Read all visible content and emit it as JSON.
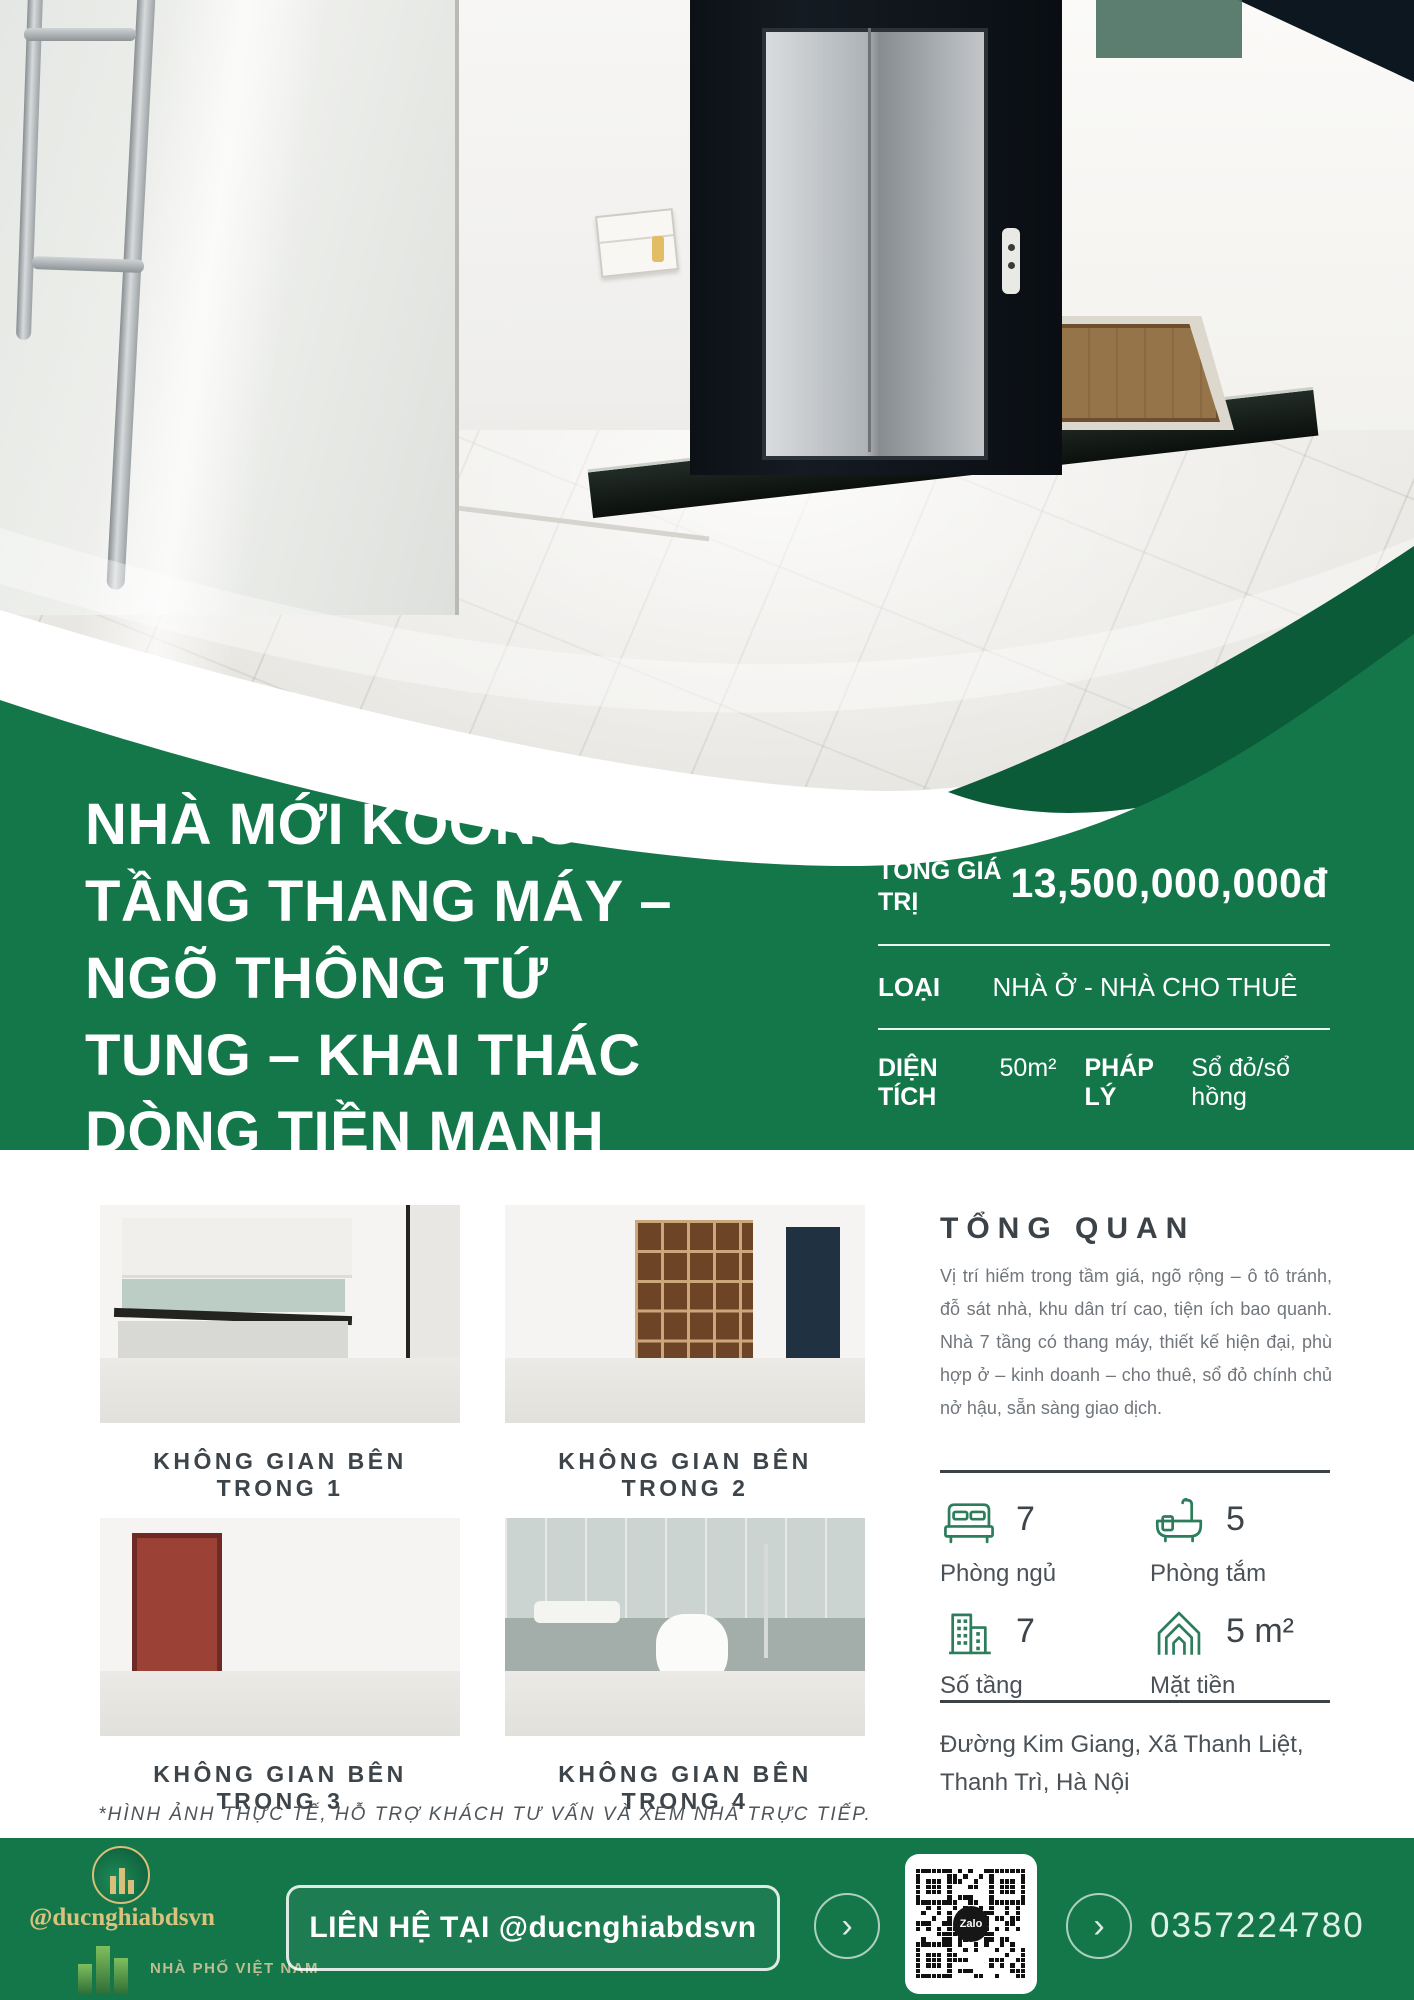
{
  "colors": {
    "primary_green": "#14774A",
    "dark_green": "#0B5B39",
    "accent_gold": "#D9C27E",
    "icon_green": "#2B7D5B"
  },
  "hero": {
    "title": "NHÀ MỚI KOONG 7\nTẦNG THANG MÁY –\nNGÕ THÔNG TỨ\nTUNG – KHAI THÁC\nDÒNG TIỀN MẠNH"
  },
  "info_panel": {
    "row1_label": "TỔNG GIÁ TRỊ",
    "row1_value": "13,500,000,000đ",
    "row2_label": "LOẠI",
    "row2_value": "NHÀ Ở - NHÀ CHO THUÊ",
    "row3a_label": "DIỆN TÍCH",
    "row3a_value": "50m²",
    "row3b_label": "PHÁP LÝ",
    "row3b_value": "Sổ đỏ/sổ hồng"
  },
  "gallery": {
    "items": [
      {
        "label": "KHÔNG GIAN BÊN TRONG 1"
      },
      {
        "label": "KHÔNG GIAN BÊN TRONG 2"
      },
      {
        "label": "KHÔNG GIAN BÊN TRONG 3"
      },
      {
        "label": "KHÔNG GIAN BÊN TRONG 4"
      }
    ],
    "disclaimer": "*HÌNH ẢNH THỰC TẾ, HỖ TRỢ KHÁCH TƯ VẤN VÀ XEM NHÀ TRỰC TIẾP."
  },
  "overview": {
    "heading": "TỔNG QUAN",
    "body": "Vị trí hiếm trong tầm giá, ngõ rộng – ô tô tránh, đỗ sát nhà, khu dân trí cao, tiện ích bao quanh. Nhà 7 tầng có thang máy, thiết kế hiện đại, phù hợp ở – kinh doanh – cho thuê, sổ đỏ chính chủ nở hậu, sẵn sàng giao dịch."
  },
  "stats": [
    {
      "icon": "bed-icon",
      "value": "7",
      "label": "Phòng ngủ"
    },
    {
      "icon": "bathtub-icon",
      "value": "5",
      "label": "Phòng tắm"
    },
    {
      "icon": "building-icon",
      "value": "7",
      "label": "Số tầng"
    },
    {
      "icon": "house-frontage-icon",
      "value": "5 m²",
      "label": "Mặt tiền"
    }
  ],
  "address": "Đường Kim Giang, Xã Thanh Liệt,\nThanh Trì, Hà Nội",
  "footer": {
    "handle": "@ducnghiabdsvn",
    "brand": "NHÀ PHỐ VIỆT NAM",
    "cta": "LIÊN HỆ TẠI @ducnghiabdsvn",
    "qr_label": "Zalo",
    "phone": "0357224780"
  }
}
